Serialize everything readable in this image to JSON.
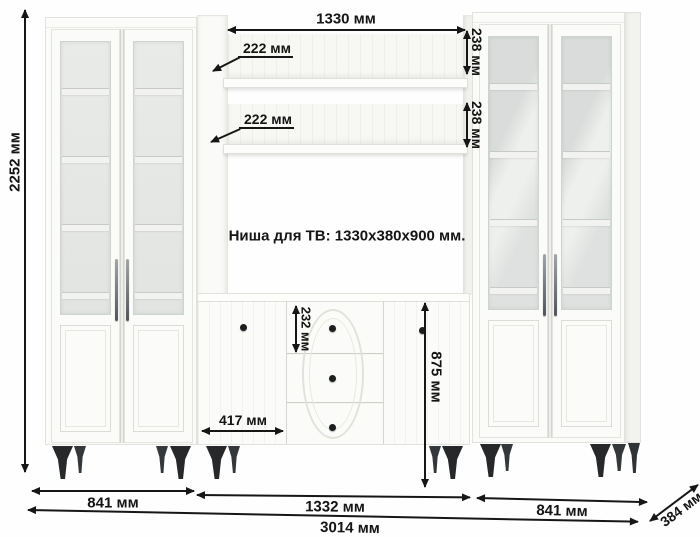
{
  "note": {
    "tv_niche": "Ниша для ТВ: 1330x380x900 мм."
  },
  "dimensions": {
    "total_height": "2252 мм",
    "niche_width": "1330 мм",
    "shelf_depth_top": "222 мм",
    "shelf_depth_bottom": "222 мм",
    "shelf_height_top": "238 мм",
    "shelf_height_bottom": "238 мм",
    "drawer_height": "232 мм",
    "door_width": "417 мм",
    "commode_height": "875 мм",
    "left_cabinet_width": "841 мм",
    "center_width": "1332 мм",
    "right_cabinet_width": "841 мм",
    "total_width": "3014 мм",
    "depth": "384 мм"
  },
  "colors": {
    "dimension_line": "#161616",
    "cabinet_white": "#fbfbf9",
    "glass_interior": "#e6e8e6",
    "legs_and_knobs": "#26282a"
  }
}
